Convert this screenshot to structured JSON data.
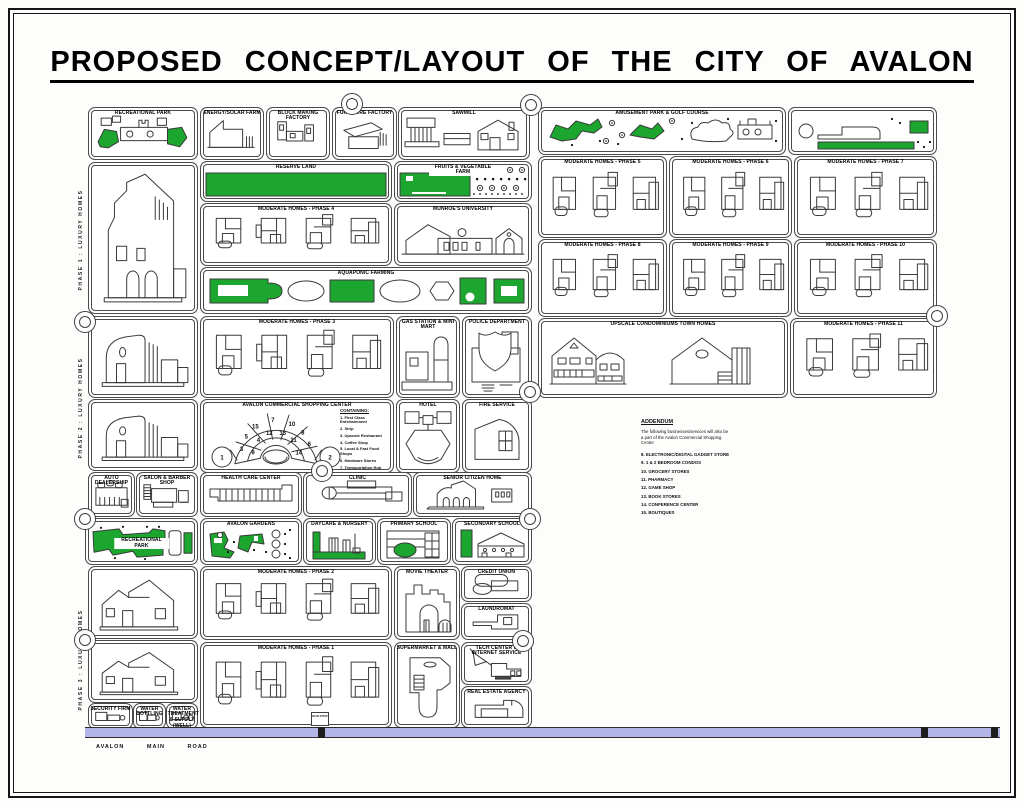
{
  "page": {
    "title": "PROPOSED  CONCEPT/LAYOUT  OF  THE  CITY  OF  AVALON"
  },
  "colors": {
    "green": "#1ca52f",
    "road": "#b3b5e8",
    "ink": "#3a3a3a"
  },
  "vertical_labels": [
    {
      "id": "phase-1-luxury-homes",
      "text": "PHASE 1 : LUXURY HOMES",
      "x": 81,
      "y": 240
    },
    {
      "id": "phase-2-luxury-homes",
      "text": "PHASE 2 : LUXURY HOMES",
      "x": 81,
      "y": 408
    },
    {
      "id": "phase-3-luxury-homes",
      "text": "PHASE 3 : LUXURY HOMES",
      "x": 81,
      "y": 660
    }
  ],
  "blocks": [
    {
      "id": "recreational-park-north",
      "label": "RECREATIONAL PARK",
      "x": 88,
      "y": 107,
      "w": 108,
      "h": 51,
      "art": "park1"
    },
    {
      "id": "luxury-home-block-1",
      "label": "",
      "x": 88,
      "y": 162,
      "w": 108,
      "h": 150,
      "art": "houseA"
    },
    {
      "id": "luxury-home-block-2",
      "label": "",
      "x": 88,
      "y": 316,
      "w": 108,
      "h": 80,
      "art": "houseB"
    },
    {
      "id": "luxury-home-block-3",
      "label": "",
      "x": 88,
      "y": 399,
      "w": 108,
      "h": 70,
      "art": "houseB"
    },
    {
      "id": "auto-dealership",
      "label": "AUTO DEALERSHIP",
      "x": 88,
      "y": 472,
      "w": 45,
      "h": 43,
      "art": "cars"
    },
    {
      "id": "salon-barber-shop",
      "label": "SALON & BARBER SHOP",
      "x": 136,
      "y": 472,
      "w": 60,
      "h": 43,
      "art": "salon"
    },
    {
      "id": "recreational-park-south",
      "label": "RECREATIONAL PARK",
      "x": 85,
      "y": 518,
      "w": 111,
      "h": 45,
      "art": "park2",
      "li": true,
      "lw": true
    },
    {
      "id": "luxury-home-block-4",
      "label": "",
      "x": 88,
      "y": 566,
      "w": 108,
      "h": 71,
      "art": "houseC"
    },
    {
      "id": "luxury-home-block-5",
      "label": "",
      "x": 88,
      "y": 640,
      "w": 108,
      "h": 61,
      "art": "houseC"
    },
    {
      "id": "security-firm",
      "label": "SECURITY FIRM",
      "x": 88,
      "y": 703,
      "w": 43,
      "h": 24,
      "art": "tinyplant"
    },
    {
      "id": "water-bottling",
      "label": "WATER BOTTLING",
      "x": 133,
      "y": 703,
      "w": 31,
      "h": 24,
      "art": "tinyplant"
    },
    {
      "id": "water-treatment",
      "label": "WATER TREATMENT & SUPPLY (WELL)",
      "x": 166,
      "y": 703,
      "w": 30,
      "h": 24,
      "art": "tinywell"
    },
    {
      "id": "energy-solar-farm",
      "label": "ENERGY/SOLAR FARM",
      "x": 200,
      "y": 107,
      "w": 62,
      "h": 51,
      "art": "factoryA"
    },
    {
      "id": "block-making-factory",
      "label": "BLOCK MAKING FACTORY",
      "x": 266,
      "y": 107,
      "w": 62,
      "h": 51,
      "art": "factoryB"
    },
    {
      "id": "furniture-factory",
      "label": "FURNITURE FACTORY",
      "x": 332,
      "y": 107,
      "w": 63,
      "h": 51,
      "art": "factoryC"
    },
    {
      "id": "sawmill",
      "label": "SAWMILL",
      "x": 398,
      "y": 107,
      "w": 130,
      "h": 51,
      "art": "sawmill"
    },
    {
      "id": "reserve-land",
      "label": "RESERVE LAND",
      "x": 200,
      "y": 161,
      "w": 190,
      "h": 39,
      "art": "greenband",
      "lw": true
    },
    {
      "id": "fruits-vegetable-farm",
      "label": "FRUITS & VEGETABLE FARM",
      "x": 394,
      "y": 161,
      "w": 136,
      "h": 39,
      "art": "fruitfarm",
      "lw": true
    },
    {
      "id": "moderate-homes-phase-4",
      "label": "MODERATE HOMES - PHASE 4",
      "x": 200,
      "y": 203,
      "w": 190,
      "h": 61,
      "art": "plans4"
    },
    {
      "id": "munroes-university",
      "label": "MUNROE'S UNIVERSITY",
      "x": 394,
      "y": 203,
      "w": 136,
      "h": 61,
      "art": "university"
    },
    {
      "id": "aquaponic-farming",
      "label": "AQUAPONIC FARMING",
      "x": 200,
      "y": 267,
      "w": 330,
      "h": 45,
      "art": "aqua"
    },
    {
      "id": "moderate-homes-phase-3",
      "label": "MODERATE HOMES - PHASE 3",
      "x": 200,
      "y": 316,
      "w": 192,
      "h": 80,
      "art": "plans4"
    },
    {
      "id": "gas-station-mini-mart",
      "label": "GAS STATION & MINI MART",
      "x": 396,
      "y": 316,
      "w": 62,
      "h": 80,
      "art": "gas"
    },
    {
      "id": "police-department",
      "label": "POLICE DEPARTMENT",
      "x": 462,
      "y": 316,
      "w": 68,
      "h": 80,
      "art": "police"
    },
    {
      "id": "avalon-commercial-shopping-center",
      "label": "AVALON COMMERCIAL SHOPPING CENTER",
      "x": 200,
      "y": 399,
      "w": 192,
      "h": 72,
      "art": "amphi"
    },
    {
      "id": "hotel",
      "label": "HOTEL",
      "x": 396,
      "y": 399,
      "w": 62,
      "h": 72,
      "art": "hotel"
    },
    {
      "id": "fire-service",
      "label": "FIRE SERVICE",
      "x": 462,
      "y": 399,
      "w": 68,
      "h": 72,
      "art": "fire"
    },
    {
      "id": "health-care-center",
      "label": "HEALTH CARE CENTER",
      "x": 200,
      "y": 472,
      "w": 100,
      "h": 43,
      "art": "longbar"
    },
    {
      "id": "clinic",
      "label": "CLINIC",
      "x": 303,
      "y": 472,
      "w": 107,
      "h": 43,
      "art": "clinicbar"
    },
    {
      "id": "senior-citizen-home",
      "label": "SENIOR CITIZEN HOME",
      "x": 413,
      "y": 472,
      "w": 117,
      "h": 43,
      "art": "seniorhome"
    },
    {
      "id": "avalon-gardens",
      "label": "AVALON GARDENS",
      "x": 200,
      "y": 518,
      "w": 100,
      "h": 45,
      "art": "gardens"
    },
    {
      "id": "daycare-nursery",
      "label": "DAYCARE & NURSERY",
      "x": 303,
      "y": 518,
      "w": 71,
      "h": 45,
      "art": "daycare"
    },
    {
      "id": "primary-school",
      "label": "PRIMARY SCHOOL",
      "x": 377,
      "y": 518,
      "w": 72,
      "h": 45,
      "art": "primary"
    },
    {
      "id": "secondary-school",
      "label": "SECONDARY SCHOOL",
      "x": 452,
      "y": 518,
      "w": 78,
      "h": 45,
      "art": "secondary"
    },
    {
      "id": "moderate-homes-phase-2",
      "label": "MODERATE HOMES - PHASE 2",
      "x": 200,
      "y": 566,
      "w": 190,
      "h": 72,
      "art": "plans4"
    },
    {
      "id": "movie-theater",
      "label": "MOVIE THEATER",
      "x": 394,
      "y": 566,
      "w": 64,
      "h": 72,
      "art": "movie"
    },
    {
      "id": "credit-union",
      "label": "CREDIT UNION",
      "x": 461,
      "y": 566,
      "w": 69,
      "h": 34,
      "art": "credit"
    },
    {
      "id": "laundromat",
      "label": "LAUNDROMAT",
      "x": 461,
      "y": 603,
      "w": 69,
      "h": 35,
      "art": "laundry"
    },
    {
      "id": "moderate-homes-phase-1",
      "label": "MODERATE HOMES - PHASE 1",
      "x": 200,
      "y": 642,
      "w": 190,
      "h": 84,
      "art": "plans4"
    },
    {
      "id": "supermarket-mall",
      "label": "SUPERMARKET & MALL",
      "x": 394,
      "y": 642,
      "w": 64,
      "h": 84,
      "art": "market"
    },
    {
      "id": "tech-center-internet",
      "label": "TECH CENTER & INTERNET SERVICE",
      "x": 461,
      "y": 642,
      "w": 69,
      "h": 41,
      "art": "tech"
    },
    {
      "id": "real-estate-agency",
      "label": "REAL ESTATE AGENCY",
      "x": 461,
      "y": 686,
      "w": 69,
      "h": 40,
      "art": "realestate"
    },
    {
      "id": "amusement-park-golf-course",
      "label": "AMUSEMENT PARK & GOLF COURSE",
      "x": 538,
      "y": 107,
      "w": 246,
      "h": 46,
      "art": "amuse1",
      "lw": true
    },
    {
      "id": "amusement-park-east",
      "label": "",
      "x": 788,
      "y": 107,
      "w": 147,
      "h": 46,
      "art": "amuse2"
    },
    {
      "id": "moderate-homes-phase-5",
      "label": "MODERATE HOMES - PHASE 5",
      "x": 538,
      "y": 156,
      "w": 127,
      "h": 80,
      "art": "plans3"
    },
    {
      "id": "moderate-homes-phase-6",
      "label": "MODERATE HOMES - PHASE 6",
      "x": 669,
      "y": 156,
      "w": 121,
      "h": 80,
      "art": "plans3"
    },
    {
      "id": "moderate-homes-phase-7",
      "label": "MODERATE HOMES - PHASE 7",
      "x": 794,
      "y": 156,
      "w": 141,
      "h": 80,
      "art": "plans3"
    },
    {
      "id": "moderate-homes-phase-8",
      "label": "MODERATE HOMES - PHASE 8",
      "x": 538,
      "y": 239,
      "w": 127,
      "h": 76,
      "art": "plans3"
    },
    {
      "id": "moderate-homes-phase-9",
      "label": "MODERATE HOMES - PHASE 9",
      "x": 669,
      "y": 239,
      "w": 121,
      "h": 76,
      "art": "plans3"
    },
    {
      "id": "moderate-homes-phase-10",
      "label": "MODERATE HOMES - PHASE 10",
      "x": 794,
      "y": 239,
      "w": 141,
      "h": 76,
      "art": "plans3"
    },
    {
      "id": "upscale-condominiums-townhomes",
      "label": "UPSCALE CONDOMINIUMS TOWN HOMES",
      "x": 538,
      "y": 318,
      "w": 248,
      "h": 78,
      "art": "upscale"
    },
    {
      "id": "moderate-homes-phase-11",
      "label": "MODERATE HOMES - PHASE 11",
      "x": 790,
      "y": 318,
      "w": 145,
      "h": 78,
      "art": "plans3"
    }
  ],
  "shopping_center": {
    "containing_title": "CONTAINING:",
    "containing": [
      "1. First Class Entertainment",
      "2. Strip",
      "3. Upscale Restaurant",
      "4. Coffee Shop",
      "5. Local & Fast Food Shops",
      "6. Hardware Stores",
      "7. Transportation Hub"
    ],
    "unit_numbers": {
      "caps": [
        "1",
        "2"
      ],
      "outer": [
        "3",
        "5",
        "15",
        "7",
        "10",
        "8",
        "6"
      ],
      "middle": [
        "9",
        "4",
        "12",
        "13",
        "11",
        "14"
      ]
    }
  },
  "addendum": {
    "title": "ADDENDUM",
    "intro": "The following businesses/services will also be a part of the Avalon Commercial Shopping Center",
    "items": [
      "8. ELECTRONIC/DIGITAL GADGET STORE",
      "9. 1 & 2 BEDROOM CONDOS",
      "10. GROCERY STORES",
      "11. PHARMACY",
      "12. GAME SHOP",
      "13. BOOK STORES",
      "14. CONFERENCE CENTER",
      "15. BOUTIQUES"
    ]
  },
  "road": {
    "label": "AVALON  MAIN  ROAD",
    "bus_stop": "BUS STOP",
    "marks": [
      318,
      921,
      991
    ]
  },
  "circles": [
    {
      "x": 352,
      "y": 104
    },
    {
      "x": 531,
      "y": 105
    },
    {
      "x": 85,
      "y": 322
    },
    {
      "x": 937,
      "y": 316
    },
    {
      "x": 530,
      "y": 392
    },
    {
      "x": 322,
      "y": 471
    },
    {
      "x": 85,
      "y": 519
    },
    {
      "x": 530,
      "y": 519
    },
    {
      "x": 523,
      "y": 641
    },
    {
      "x": 85,
      "y": 640
    }
  ]
}
